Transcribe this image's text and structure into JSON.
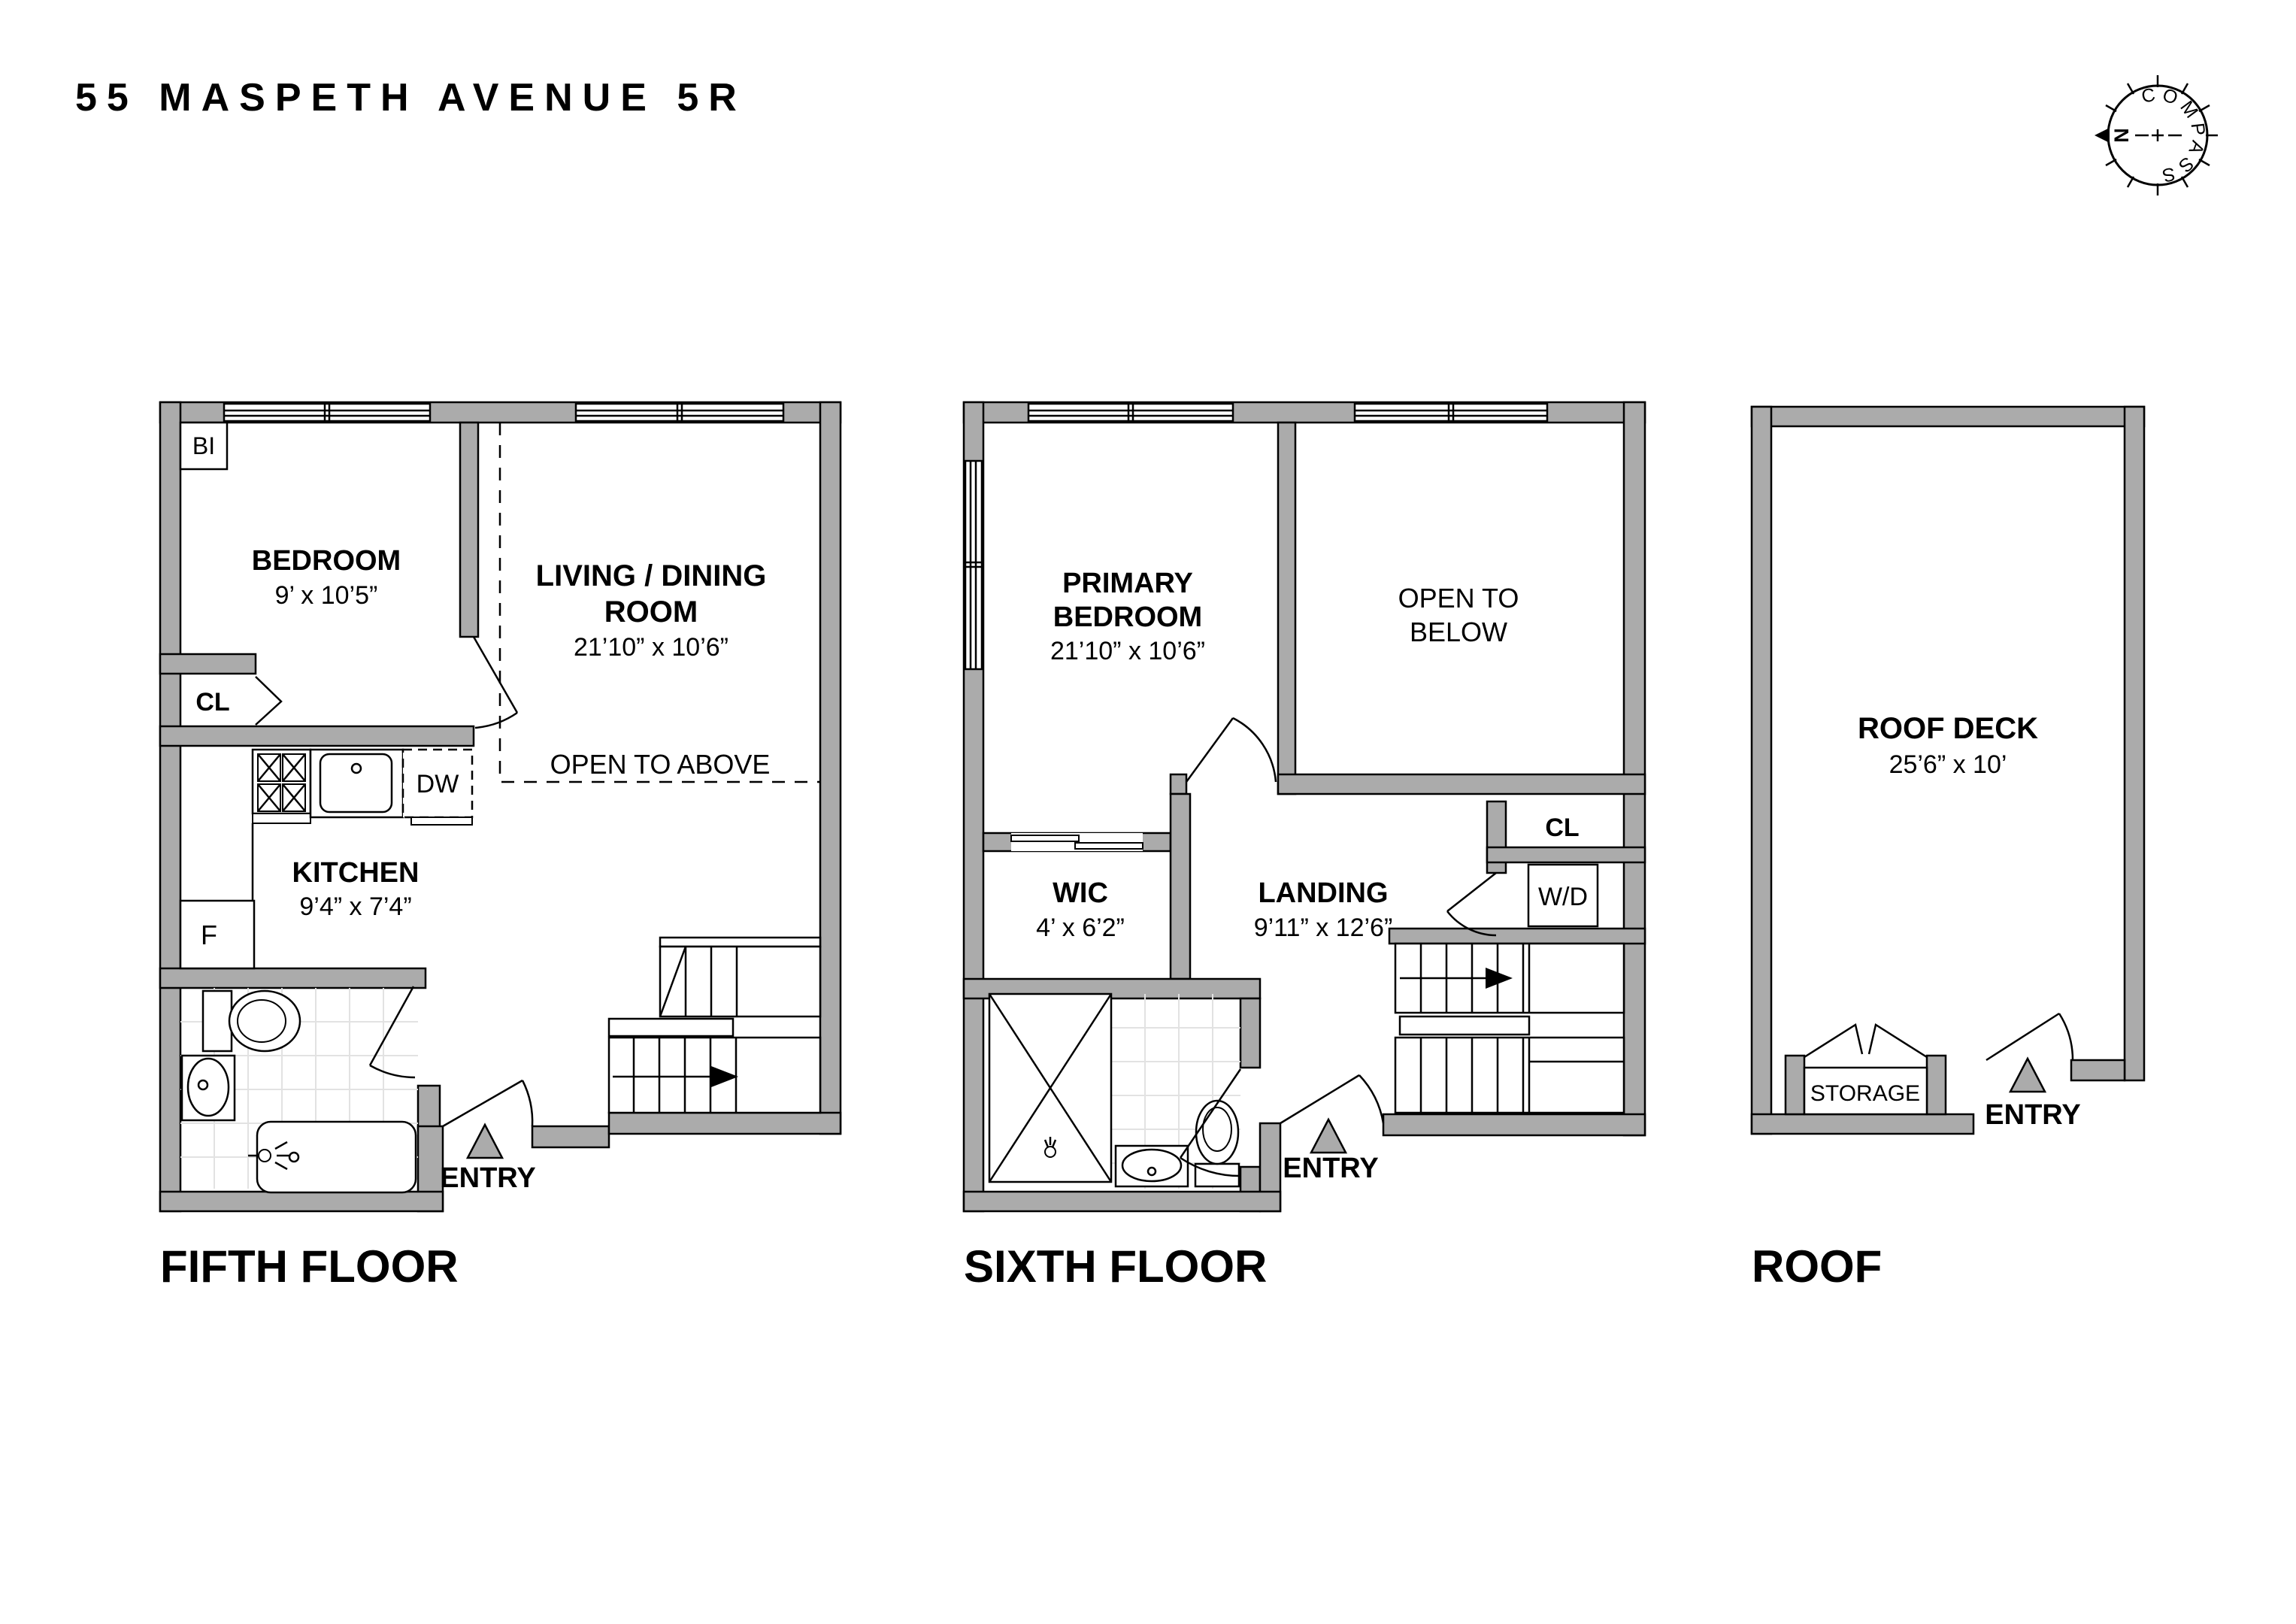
{
  "title": "55 MASPETH AVENUE 5R",
  "compass": {
    "label": "COMPASS",
    "north": "N"
  },
  "floors": {
    "fifth": {
      "label": "FIFTH FLOOR",
      "bi": "BI",
      "bedroom": {
        "name": "BEDROOM",
        "dims": "9’ x 10’5”"
      },
      "closet": "CL",
      "living": {
        "line1": "LIVING / DINING",
        "line2": "ROOM",
        "dims": "21’10” x 10’6”"
      },
      "open_to_above": "OPEN TO ABOVE",
      "dishwasher": "DW",
      "kitchen": {
        "name": "KITCHEN",
        "dims": "9’4” x 7’4”"
      },
      "fridge": "F",
      "entry": "ENTRY"
    },
    "sixth": {
      "label": "SIXTH FLOOR",
      "primary": {
        "line1": "PRIMARY",
        "line2": "BEDROOM",
        "dims": "21’10” x 10’6”"
      },
      "open_below": {
        "line1": "OPEN TO",
        "line2": "BELOW"
      },
      "closet": "CL",
      "washer_dryer": "W/D",
      "wic": {
        "name": "WIC",
        "dims": "4’ x 6’2”"
      },
      "landing": {
        "name": "LANDING",
        "dims": "9’11” x 12’6”"
      },
      "entry": "ENTRY"
    },
    "roof": {
      "label": "ROOF",
      "deck": {
        "name": "ROOF DECK",
        "dims": "25’6” x 10’"
      },
      "storage": "STORAGE",
      "entry": "ENTRY"
    }
  }
}
